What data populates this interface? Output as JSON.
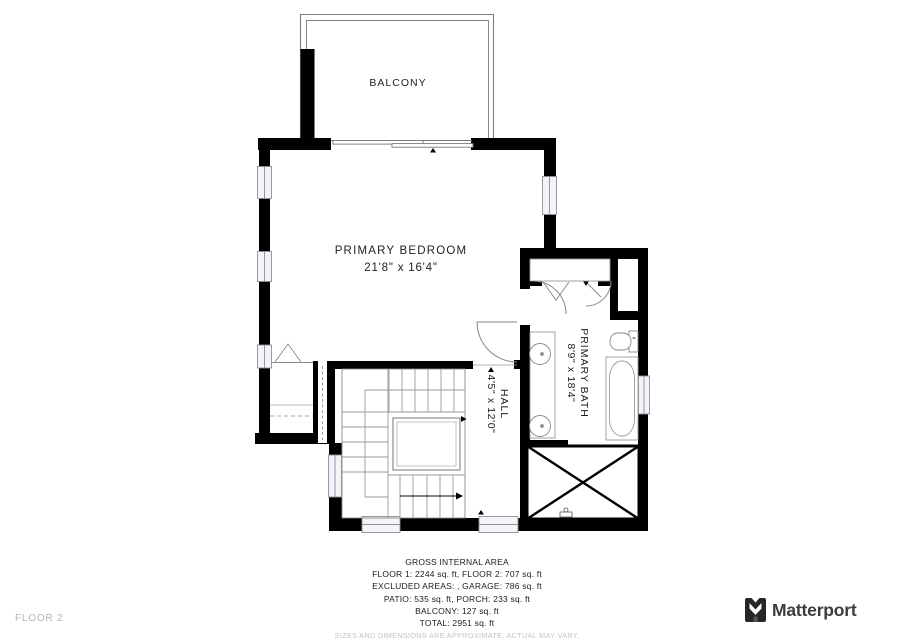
{
  "floorplan": {
    "floor_label": "FLOOR 2",
    "rooms": {
      "balcony": {
        "name": "BALCONY"
      },
      "primary_bedroom": {
        "name": "PRIMARY BEDROOM",
        "dimensions": "21'8\" x 16'4\""
      },
      "primary_bath": {
        "name": "PRIMARY BATH",
        "dimensions": "8'9\" x 18'4\""
      },
      "hall": {
        "name": "HALL",
        "dimensions": "4'5\" x 12'0\""
      }
    }
  },
  "summary": {
    "title": "GROSS INTERNAL AREA",
    "lines": [
      "FLOOR 1: 2244 sq. ft, FLOOR 2: 707 sq. ft",
      "EXCLUDED AREAS: , GARAGE: 786 sq. ft",
      "PATIO: 535 sq. ft, PORCH: 233 sq. ft",
      "BALCONY: 127 sq. ft",
      "TOTAL: 2951 sq. ft"
    ],
    "disclaimer": "SIZES AND DIMENSIONS ARE APPROXIMATE, ACTUAL MAY VARY."
  },
  "branding": {
    "logo_text": "Matterport"
  },
  "colors": {
    "wall": "#000000",
    "thin_line": "#888888",
    "window_frame": "#8f8f99",
    "label_text": "#1f1f1f",
    "muted_text": "#b4b4b4",
    "logo_text": "#3d3d3d"
  }
}
